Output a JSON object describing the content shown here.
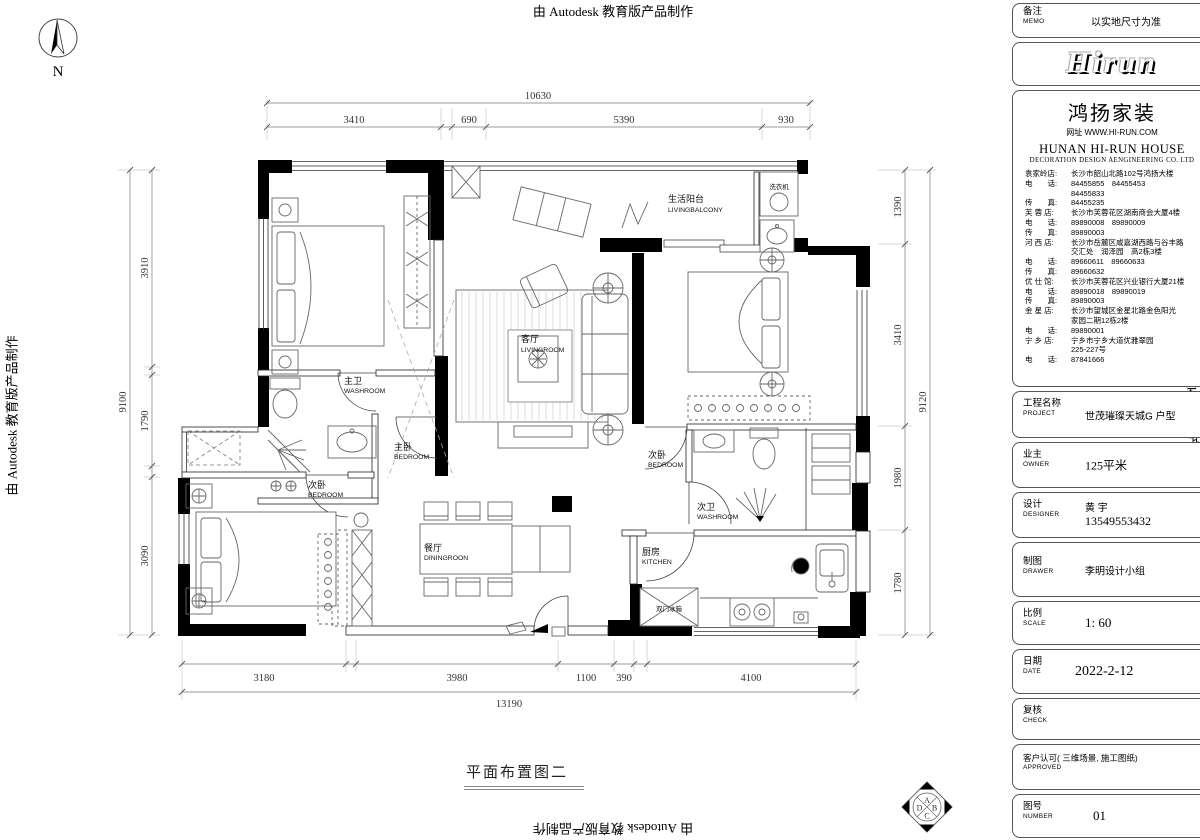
{
  "border": {
    "autodesk_text": "由 Autodesk 教育版产品制作"
  },
  "plan": {
    "title": "平面布置图二",
    "north_label": "N",
    "rooms": {
      "living_balcony": {
        "cn": "生活阳台",
        "en": "LIVINGBALCONY"
      },
      "living": {
        "cn": "客厅",
        "en": "LIVINGROOM"
      },
      "master_bath": {
        "cn": "主卫",
        "en": "WASHROOM"
      },
      "master_bed": {
        "cn": "主卧",
        "en": "BEDROOM"
      },
      "bed2_left": {
        "cn": "次卧",
        "en": "BEDROOM"
      },
      "bed2_right": {
        "cn": "次卧",
        "en": "BEDROOM"
      },
      "bath2": {
        "cn": "次卫",
        "en": "WASHROOM"
      },
      "dining": {
        "cn": "餐厅",
        "en": "DININGROON"
      },
      "kitchen": {
        "cn": "厨房",
        "en": "KITCHEN"
      }
    },
    "fixtures": {
      "washing_machine": "洗衣机",
      "fridge": "双门冰箱"
    },
    "dims": {
      "top": {
        "overall": "10630",
        "segments": [
          "3410",
          "690",
          "5390",
          "930"
        ]
      },
      "bottom": {
        "overall": "13190",
        "segments": [
          "3180",
          "3980",
          "1100",
          "390",
          "4100"
        ]
      },
      "left": {
        "overall": "9100",
        "segments": [
          "3910",
          "1790",
          "3090"
        ]
      },
      "right": {
        "overall": "9120",
        "segments": [
          "1390",
          "3410",
          "1980",
          "1780"
        ]
      }
    },
    "stamp": {
      "letters": [
        "A",
        "B",
        "C",
        "D"
      ]
    }
  },
  "titleblock": {
    "memo": {
      "cn": "备注",
      "en": "MEMO",
      "value": "以实地尺寸为准"
    },
    "logo": "Hirun",
    "company": {
      "name": "鸿扬家装",
      "website": "网址 WWW.HI-RUN.COM",
      "name_en": "HUNAN HI-RUN HOUSE",
      "subtitle_en": "DECORATION DESIGN AENGINEERING CO. LTD",
      "lines": [
        {
          "l": "袁家岭店:",
          "v": "长沙市韶山北路102号鸿扬大楼"
        },
        {
          "l": "电　　话:",
          "v": "84455855　84455453"
        },
        {
          "l": "",
          "v": "84455833"
        },
        {
          "l": "传　　真:",
          "v": "84455235"
        },
        {
          "l": "芙 蓉 店:",
          "v": "长沙市芙蓉花区湖南商会大厦4楼"
        },
        {
          "l": "电　　话:",
          "v": "89890008　89890009"
        },
        {
          "l": "传　　真:",
          "v": "89890003"
        },
        {
          "l": "河 西 店:",
          "v": "长沙市岳麓区咸嘉湖西路与谷丰路"
        },
        {
          "l": "",
          "v": "交汇处　润泽园　高2栋3楼"
        },
        {
          "l": "电　　话:",
          "v": "89660611　89660633"
        },
        {
          "l": "传　　真:",
          "v": "89660632"
        },
        {
          "l": "优 仕 馆:",
          "v": "长沙市芙蓉花区兴业银行大厦21楼"
        },
        {
          "l": "电　　话:",
          "v": "89890018　89890019"
        },
        {
          "l": "传　　真:",
          "v": "89890003"
        },
        {
          "l": "金 星 店:",
          "v": "长沙市望城区金星北路金色阳光"
        },
        {
          "l": "",
          "v": "家园二期12栋2楼"
        },
        {
          "l": "电　　话:",
          "v": "89890001"
        },
        {
          "l": "宁 乡 店:",
          "v": "宁乡市宁乡大道优雅翠园"
        },
        {
          "l": "",
          "v": "225-227号"
        },
        {
          "l": "电　　话:",
          "v": "87841666"
        }
      ]
    },
    "project": {
      "cn": "工程名称",
      "en": "PROJECT",
      "value": "世茂璀璨天城G 户型"
    },
    "owner": {
      "cn": "业主",
      "en": "OWNER",
      "value": "125平米"
    },
    "designer": {
      "cn": "设计",
      "en": "DESIGNER",
      "value": "黄 宇",
      "phone": "13549553432"
    },
    "drawer": {
      "cn": "制图",
      "en": "DRAWER",
      "value": "李明设计小组"
    },
    "scale": {
      "cn": "比例",
      "en": "SCALE",
      "value": "1: 60"
    },
    "date": {
      "cn": "日期",
      "en": "DATE",
      "value": "2022-2-12"
    },
    "check": {
      "cn": "复核",
      "en": "CHECK",
      "value": ""
    },
    "approved": {
      "cn": "客户认可( 三维场景, 施工图纸)",
      "en": "APPROVED",
      "value": ""
    },
    "number": {
      "cn": "图号",
      "en": "NUMBER",
      "value": "01"
    }
  }
}
